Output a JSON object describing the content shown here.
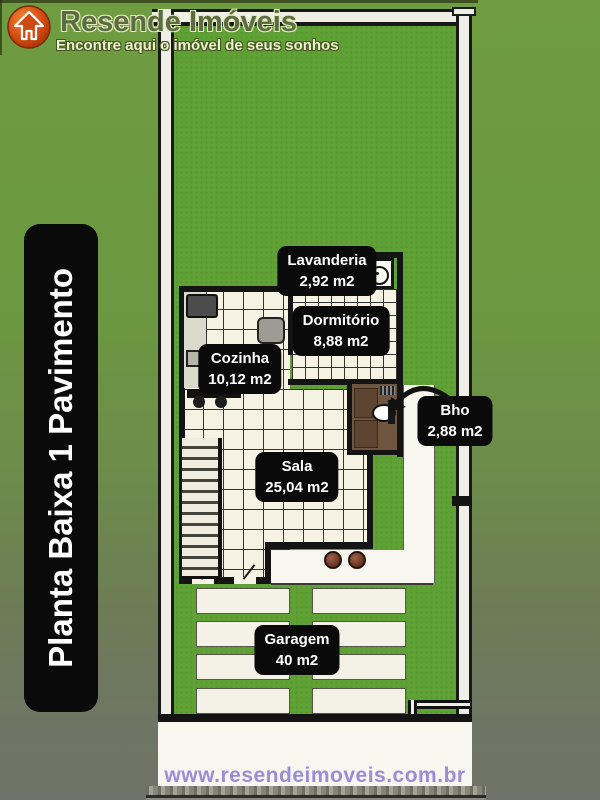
{
  "header": {
    "brand": "Resende Imóveis",
    "tagline": "Encontre aqui o imóvel de seus sonhos",
    "logo_icon": "house-arrow-icon"
  },
  "side_banner": {
    "text": "Planta Baixa 1 Pavimento"
  },
  "floorplan": {
    "rooms": [
      {
        "name": "Lavanderia",
        "area": "2,92 m2"
      },
      {
        "name": "Dormitório",
        "area": "8,88 m2"
      },
      {
        "name": "Cozinha",
        "area": "10,12 m2"
      },
      {
        "name": "Bho",
        "area": "2,88 m2"
      },
      {
        "name": "Sala",
        "area": "25,04 m2"
      },
      {
        "name": "Garagem",
        "area": "40 m2"
      }
    ],
    "icons": [
      "washing-machine-icon",
      "toilet-icon",
      "stove-icon",
      "fridge-icon",
      "sink-icon",
      "stairs",
      "gate",
      "fence"
    ]
  },
  "footer": {
    "website": "www.resendeimoveis.com.br"
  },
  "colors": {
    "grass": "#60a136",
    "background_top": "#6f9c41",
    "background_bottom": "#707468",
    "label_background": "#0a0a0a",
    "label_text": "#ffffff",
    "url_text": "#988dd8",
    "logo_orange": "#d14a12"
  }
}
